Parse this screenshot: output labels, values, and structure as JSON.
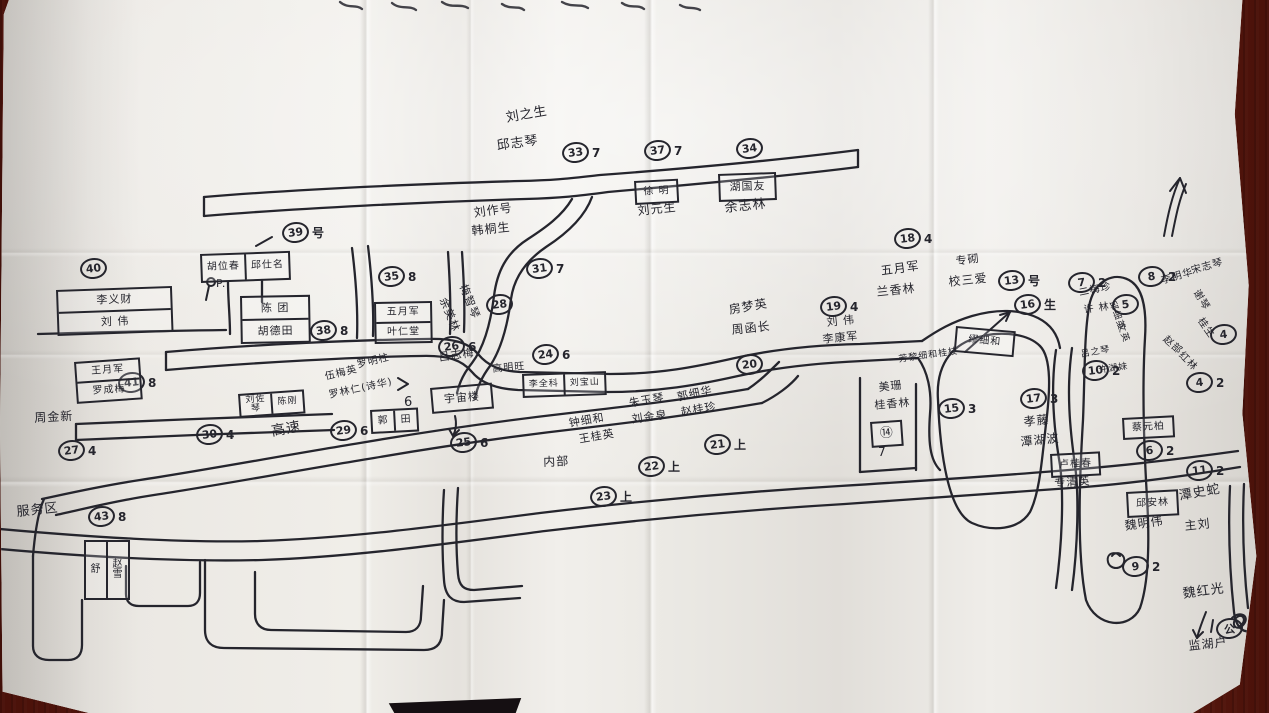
{
  "photo": {
    "surface_color": "#541409",
    "paper_color": "#eae7e2",
    "ink_color": "#25252d"
  },
  "map": {
    "markers": [
      {
        "n": "40",
        "s": "",
        "x": 80,
        "y": 258
      },
      {
        "n": "39",
        "s": "号",
        "x": 282,
        "y": 222
      },
      {
        "n": "38",
        "s": "8",
        "x": 310,
        "y": 320
      },
      {
        "n": "41",
        "s": "8",
        "x": 118,
        "y": 372
      },
      {
        "n": "35",
        "s": "8",
        "x": 378,
        "y": 266
      },
      {
        "n": "31",
        "s": "7",
        "x": 526,
        "y": 258
      },
      {
        "n": "33",
        "s": "7",
        "x": 562,
        "y": 142
      },
      {
        "n": "37",
        "s": "7",
        "x": 644,
        "y": 140
      },
      {
        "n": "34",
        "s": "",
        "x": 736,
        "y": 138
      },
      {
        "n": "28",
        "s": "",
        "x": 486,
        "y": 294
      },
      {
        "n": "26",
        "s": "6",
        "x": 438,
        "y": 336
      },
      {
        "n": "24",
        "s": "6",
        "x": 532,
        "y": 344
      },
      {
        "n": "25",
        "s": "6",
        "x": 450,
        "y": 432
      },
      {
        "n": "29",
        "s": "6",
        "x": 330,
        "y": 420
      },
      {
        "n": "30",
        "s": "4",
        "x": 196,
        "y": 424
      },
      {
        "n": "27",
        "s": "4",
        "x": 58,
        "y": 440
      },
      {
        "n": "23",
        "s": "上",
        "x": 590,
        "y": 486
      },
      {
        "n": "22",
        "s": "上",
        "x": 638,
        "y": 456
      },
      {
        "n": "21",
        "s": "上",
        "x": 704,
        "y": 434
      },
      {
        "n": "20",
        "s": "",
        "x": 736,
        "y": 354
      },
      {
        "n": "19",
        "s": "4",
        "x": 820,
        "y": 296
      },
      {
        "n": "18",
        "s": "4",
        "x": 894,
        "y": 228
      },
      {
        "n": "13",
        "s": "号",
        "x": 998,
        "y": 270
      },
      {
        "n": "16",
        "s": "生",
        "x": 1014,
        "y": 294
      },
      {
        "n": "15",
        "s": "3",
        "x": 938,
        "y": 398
      },
      {
        "n": "17",
        "s": "3",
        "x": 1020,
        "y": 388
      },
      {
        "n": "43",
        "s": "8",
        "x": 88,
        "y": 506
      },
      {
        "n": "11",
        "s": "2",
        "x": 1186,
        "y": 460
      },
      {
        "n": "6",
        "s": "2",
        "x": 1136,
        "y": 440
      },
      {
        "n": "9",
        "s": "2",
        "x": 1122,
        "y": 556
      },
      {
        "n": "8",
        "s": "2",
        "x": 1138,
        "y": 266
      },
      {
        "n": "7",
        "s": "2",
        "x": 1068,
        "y": 272
      },
      {
        "n": "10",
        "s": "2",
        "x": 1082,
        "y": 360
      },
      {
        "n": "5",
        "s": "",
        "x": 1112,
        "y": 294
      },
      {
        "n": "4",
        "s": "",
        "x": 1210,
        "y": 324
      },
      {
        "n": "4",
        "s": "2",
        "x": 1186,
        "y": 372
      },
      {
        "n": "公",
        "s": "",
        "x": 1216,
        "y": 618
      }
    ],
    "houses": [
      {
        "dir": "rows",
        "cells": [
          "李义财",
          "刘 伟"
        ],
        "x": 56,
        "y": 290,
        "w": 112,
        "h": 42,
        "r": -2
      },
      {
        "dir": "rows",
        "cells": [
          "王月军",
          "罗成梅"
        ],
        "x": 74,
        "y": 362,
        "w": 62,
        "h": 38,
        "r": -4,
        "fs": 10
      },
      {
        "dir": "cols",
        "cells": [
          "胡位春",
          "邱仕名"
        ],
        "x": 200,
        "y": 254,
        "w": 86,
        "h": 25,
        "r": -2,
        "fs": 10
      },
      {
        "dir": "rows",
        "cells": [
          "陈 团",
          "胡德田"
        ],
        "x": 240,
        "y": 296,
        "w": 66,
        "h": 44,
        "r": -1
      },
      {
        "dir": "cols",
        "cells": [
          "刘佐琴",
          "陈刚"
        ],
        "x": 238,
        "y": 394,
        "w": 62,
        "h": 20,
        "r": -4,
        "fs": 9
      },
      {
        "dir": "rows",
        "cells": [
          "五月军",
          "叶仁堂"
        ],
        "x": 374,
        "y": 302,
        "w": 54,
        "h": 38,
        "r": -1,
        "fs": 10
      },
      {
        "dir": "rows",
        "cells": [
          "宇宙楼"
        ],
        "x": 430,
        "y": 388,
        "w": 58,
        "h": 22,
        "r": -5
      },
      {
        "dir": "cols",
        "cells": [
          "郭",
          "田"
        ],
        "x": 370,
        "y": 410,
        "w": 44,
        "h": 20,
        "r": -3,
        "fs": 10
      },
      {
        "dir": "cols",
        "cells": [
          "李全科",
          "刘宝山"
        ],
        "x": 522,
        "y": 374,
        "w": 80,
        "h": 20,
        "r": -2,
        "fs": 9
      },
      {
        "dir": "rows",
        "cells": [
          "湖国友"
        ],
        "x": 718,
        "y": 174,
        "w": 54,
        "h": 24,
        "r": -2
      },
      {
        "dir": "rows",
        "cells": [
          "徐 明"
        ],
        "x": 634,
        "y": 181,
        "w": 40,
        "h": 20,
        "r": -3,
        "fs": 10
      },
      {
        "dir": "rows",
        "cells": [
          "⑭"
        ],
        "x": 870,
        "y": 422,
        "w": 28,
        "h": 22,
        "r": -4,
        "fs": 13
      },
      {
        "dir": "rows",
        "cells": [
          "缪细和"
        ],
        "x": 956,
        "y": 326,
        "w": 56,
        "h": 22,
        "r": 5,
        "fs": 10
      },
      {
        "dir": "rows",
        "cells": [
          "卢桂春"
        ],
        "x": 1050,
        "y": 454,
        "w": 46,
        "h": 20,
        "r": -3,
        "fs": 10
      },
      {
        "dir": "rows",
        "cells": [
          "蔡元柏"
        ],
        "x": 1122,
        "y": 418,
        "w": 48,
        "h": 18,
        "r": -3,
        "fs": 10
      },
      {
        "dir": "rows",
        "cells": [
          "邱安林"
        ],
        "x": 1126,
        "y": 492,
        "w": 48,
        "h": 22,
        "r": -3,
        "fs": 10
      },
      {
        "dir": "cols",
        "cells": [
          "舒",
          "赵\n雪"
        ],
        "x": 84,
        "y": 540,
        "w": 42,
        "h": 56,
        "r": 0,
        "fs": 10
      }
    ],
    "labels": [
      {
        "t": "刘之生",
        "x": 505,
        "y": 112,
        "s": 13,
        "r": -10
      },
      {
        "t": "邱志琴",
        "x": 496,
        "y": 140,
        "s": 13,
        "r": -8
      },
      {
        "t": "刘作号",
        "x": 473,
        "y": 207,
        "s": 12,
        "r": -8
      },
      {
        "t": "韩桐生",
        "x": 471,
        "y": 225,
        "s": 12,
        "r": -6
      },
      {
        "t": "刘元生",
        "x": 637,
        "y": 205,
        "s": 12,
        "r": -6
      },
      {
        "t": "余志林",
        "x": 724,
        "y": 202,
        "s": 13,
        "r": -6
      },
      {
        "t": "梅智琴",
        "x": 468,
        "y": 283,
        "s": 11,
        "r": 68
      },
      {
        "t": "余美林",
        "x": 448,
        "y": 296,
        "s": 11,
        "r": 68
      },
      {
        "t": "吕志梅",
        "x": 438,
        "y": 352,
        "s": 11,
        "r": -8
      },
      {
        "t": "高明旺",
        "x": 492,
        "y": 364,
        "s": 10,
        "r": -5
      },
      {
        "t": "罗明柱",
        "x": 356,
        "y": 360,
        "s": 10,
        "r": -14
      },
      {
        "t": "伍梅英",
        "x": 324,
        "y": 372,
        "s": 10,
        "r": -14
      },
      {
        "t": "罗林仁(诗华)",
        "x": 328,
        "y": 390,
        "s": 10,
        "r": -12
      },
      {
        "t": "6",
        "x": 404,
        "y": 396,
        "s": 13,
        "r": 0
      },
      {
        "t": "高速",
        "x": 270,
        "y": 424,
        "s": 14,
        "r": -10
      },
      {
        "t": "周金新",
        "x": 34,
        "y": 412,
        "s": 12,
        "r": -3
      },
      {
        "t": "服务区",
        "x": 16,
        "y": 506,
        "s": 13,
        "r": -6
      },
      {
        "t": "钟细和",
        "x": 568,
        "y": 418,
        "s": 11,
        "r": -10
      },
      {
        "t": "王桂英",
        "x": 578,
        "y": 434,
        "s": 11,
        "r": -10
      },
      {
        "t": "内部",
        "x": 543,
        "y": 456,
        "s": 12,
        "r": -2
      },
      {
        "t": "朱玉琴",
        "x": 628,
        "y": 398,
        "s": 11,
        "r": -10
      },
      {
        "t": "刘金泉",
        "x": 631,
        "y": 414,
        "s": 11,
        "r": -8
      },
      {
        "t": "郭细华",
        "x": 676,
        "y": 392,
        "s": 11,
        "r": -12
      },
      {
        "t": "赵桂珍",
        "x": 680,
        "y": 407,
        "s": 11,
        "r": -10
      },
      {
        "t": "房梦英",
        "x": 728,
        "y": 304,
        "s": 12,
        "r": -10
      },
      {
        "t": "周函长",
        "x": 731,
        "y": 324,
        "s": 12,
        "r": -6
      },
      {
        "t": "刘 伟",
        "x": 826,
        "y": 317,
        "s": 11,
        "r": -6
      },
      {
        "t": "李康军",
        "x": 822,
        "y": 334,
        "s": 11,
        "r": -6
      },
      {
        "t": "五月军",
        "x": 880,
        "y": 265,
        "s": 12,
        "r": -8
      },
      {
        "t": "兰香林",
        "x": 876,
        "y": 286,
        "s": 12,
        "r": -6
      },
      {
        "t": "专砌",
        "x": 955,
        "y": 256,
        "s": 11,
        "r": -8
      },
      {
        "t": "校三爱",
        "x": 948,
        "y": 276,
        "s": 12,
        "r": -6
      },
      {
        "t": "芳黎细和桂枝",
        "x": 898,
        "y": 355,
        "s": 9,
        "r": -8
      },
      {
        "t": "美珊",
        "x": 878,
        "y": 382,
        "s": 11,
        "r": -6
      },
      {
        "t": "桂香林",
        "x": 874,
        "y": 400,
        "s": 11,
        "r": -5
      },
      {
        "t": "7",
        "x": 878,
        "y": 446,
        "s": 12,
        "r": 0
      },
      {
        "t": "孝藤",
        "x": 1023,
        "y": 416,
        "s": 12,
        "r": -6
      },
      {
        "t": "潭湖波",
        "x": 1020,
        "y": 436,
        "s": 12,
        "r": -6
      },
      {
        "t": "专清英",
        "x": 1054,
        "y": 478,
        "s": 11,
        "r": -4
      },
      {
        "t": "二梅珍",
        "x": 1078,
        "y": 288,
        "s": 10,
        "r": -12
      },
      {
        "t": "许 林",
        "x": 1083,
        "y": 305,
        "s": 10,
        "r": -8
      },
      {
        "t": "邱细英",
        "x": 1116,
        "y": 300,
        "s": 9,
        "r": 70
      },
      {
        "t": "文英",
        "x": 1124,
        "y": 322,
        "s": 9,
        "r": 70
      },
      {
        "t": "李明华",
        "x": 1160,
        "y": 276,
        "s": 10,
        "r": -16
      },
      {
        "t": "宋志琴",
        "x": 1190,
        "y": 266,
        "s": 10,
        "r": -16
      },
      {
        "t": "吕之琴",
        "x": 1080,
        "y": 350,
        "s": 9,
        "r": -10
      },
      {
        "t": "许湖妹",
        "x": 1098,
        "y": 366,
        "s": 9,
        "r": -8
      },
      {
        "t": "谢琴",
        "x": 1200,
        "y": 288,
        "s": 10,
        "r": 58
      },
      {
        "t": "桂生",
        "x": 1204,
        "y": 316,
        "s": 10,
        "r": 55
      },
      {
        "t": "赵部",
        "x": 1168,
        "y": 334,
        "s": 10,
        "r": 42
      },
      {
        "t": "红林",
        "x": 1184,
        "y": 350,
        "s": 10,
        "r": 45
      },
      {
        "t": "魏明伟",
        "x": 1124,
        "y": 520,
        "s": 12,
        "r": -8
      },
      {
        "t": "潭史蛇",
        "x": 1178,
        "y": 490,
        "s": 13,
        "r": -10
      },
      {
        "t": "主刘",
        "x": 1184,
        "y": 520,
        "s": 12,
        "r": -6
      },
      {
        "t": "魏红光",
        "x": 1182,
        "y": 588,
        "s": 13,
        "r": -8
      },
      {
        "t": "监湖户",
        "x": 1188,
        "y": 640,
        "s": 12,
        "r": -6
      },
      {
        "t": "P.",
        "x": 216,
        "y": 278,
        "s": 11,
        "r": 0
      }
    ]
  }
}
